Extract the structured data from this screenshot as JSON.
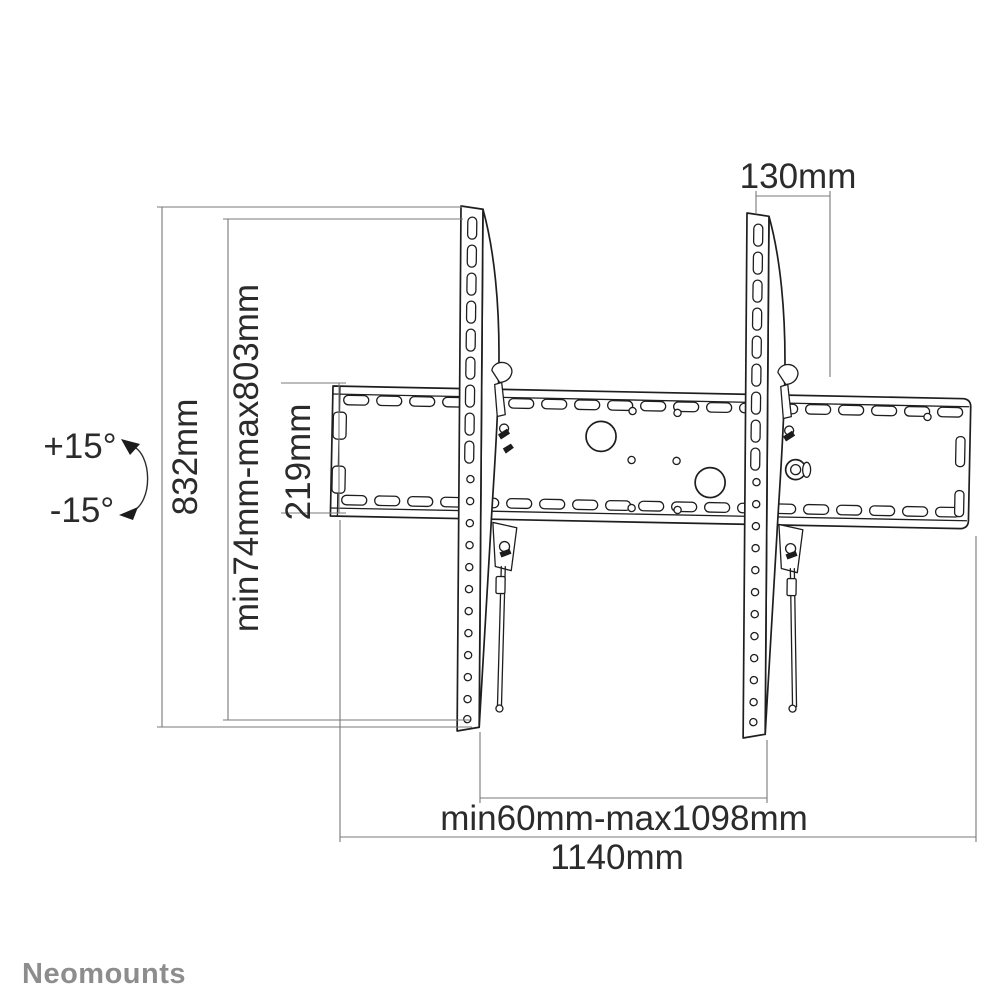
{
  "drawing": {
    "subject": "tilting TV wall mount - front technical drawing with dimensions",
    "line_color": "#1e1e1e",
    "dim_line_color": "#787878",
    "text_color": "#2b2b2b",
    "background": "#ffffff"
  },
  "brand": {
    "name": "Neomounts",
    "color": "#8d8d8d"
  },
  "dimensions": {
    "bracket_top_offset": "130mm",
    "overall_height": "832mm",
    "mount_height_range": "min74mm-max803mm",
    "plate_height": "219mm",
    "mount_width_range": "min60mm-max1098mm",
    "plate_width": "1140mm",
    "tilt_up": "+15°",
    "tilt_down": "-15°"
  }
}
